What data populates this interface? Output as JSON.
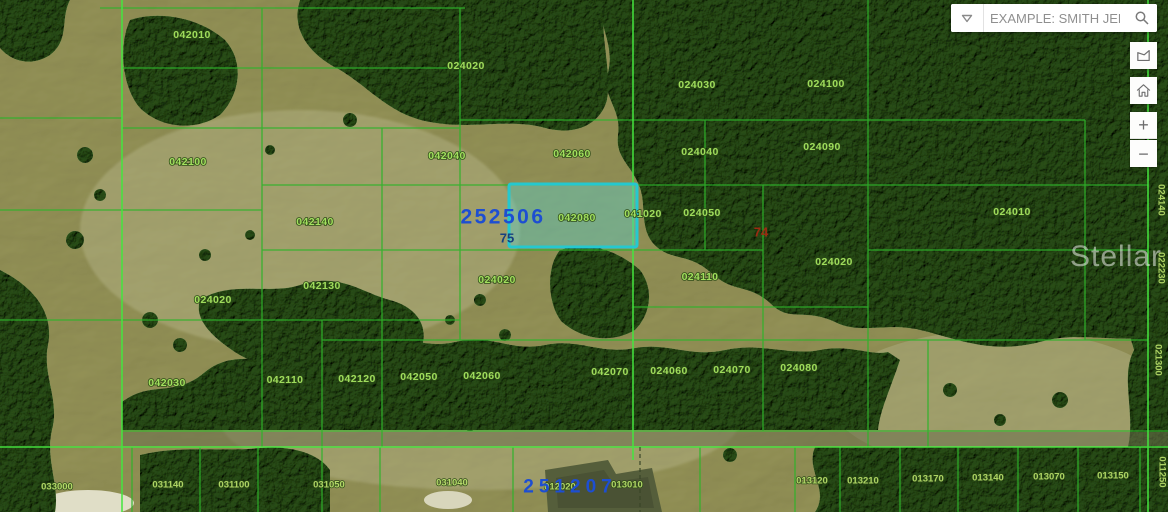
{
  "search": {
    "placeholder": "EXAMPLE: SMITH JER..."
  },
  "controls": {
    "zoom_in_label": "+",
    "zoom_out_label": "−"
  },
  "watermark": "Stellar MLS",
  "selected_parcel": {
    "section_label": "252506",
    "lot_label": "75",
    "parcel_id": "042080",
    "highlight_border_color": "#25c8cf",
    "highlight_fill_color": "rgba(90,210,205,0.42)"
  },
  "colors": {
    "parcel_line_green": "#2eb32a",
    "parcel_line_bright": "#45e53f",
    "parcel_label_green": "#a4e35f",
    "section_label_blue": "#1d4ed2",
    "note_red": "#9c2b12"
  },
  "map_labels": {
    "green_parcels": [
      {
        "t": "042010",
        "x": 192,
        "y": 35
      },
      {
        "t": "024020",
        "x": 466,
        "y": 66
      },
      {
        "t": "024030",
        "x": 697,
        "y": 85
      },
      {
        "t": "024100",
        "x": 826,
        "y": 84
      },
      {
        "t": "042100",
        "x": 188,
        "y": 162
      },
      {
        "t": "042040",
        "x": 447,
        "y": 156
      },
      {
        "t": "042060",
        "x": 572,
        "y": 154
      },
      {
        "t": "024040",
        "x": 700,
        "y": 152
      },
      {
        "t": "024090",
        "x": 822,
        "y": 147
      },
      {
        "t": "042080",
        "x": 577,
        "y": 218
      },
      {
        "t": "041020",
        "x": 643,
        "y": 214
      },
      {
        "t": "024050",
        "x": 702,
        "y": 213
      },
      {
        "t": "024010",
        "x": 1012,
        "y": 212
      },
      {
        "t": "042140",
        "x": 315,
        "y": 222
      },
      {
        "t": "024020",
        "x": 834,
        "y": 262
      },
      {
        "t": "042130",
        "x": 322,
        "y": 286
      },
      {
        "t": "024020",
        "x": 213,
        "y": 300
      },
      {
        "t": "024020",
        "x": 497,
        "y": 280
      },
      {
        "t": "024110",
        "x": 700,
        "y": 277
      },
      {
        "t": "042030",
        "x": 167,
        "y": 383
      },
      {
        "t": "042110",
        "x": 285,
        "y": 380
      },
      {
        "t": "042120",
        "x": 357,
        "y": 379
      },
      {
        "t": "042050",
        "x": 419,
        "y": 377
      },
      {
        "t": "042060",
        "x": 482,
        "y": 376
      },
      {
        "t": "042070",
        "x": 610,
        "y": 372
      },
      {
        "t": "024060",
        "x": 669,
        "y": 371
      },
      {
        "t": "024070",
        "x": 732,
        "y": 370
      },
      {
        "t": "024080",
        "x": 799,
        "y": 368
      },
      {
        "t": "033000",
        "x": 57,
        "y": 487,
        "sm": 1
      },
      {
        "t": "031140",
        "x": 168,
        "y": 485,
        "sm": 1
      },
      {
        "t": "031100",
        "x": 234,
        "y": 485,
        "sm": 1
      },
      {
        "t": "031050",
        "x": 329,
        "y": 485,
        "sm": 1
      },
      {
        "t": "031040",
        "x": 452,
        "y": 483,
        "sm": 1
      },
      {
        "t": "012020",
        "x": 560,
        "y": 487,
        "sm": 1
      },
      {
        "t": "013010",
        "x": 627,
        "y": 485,
        "sm": 1
      },
      {
        "t": "013120",
        "x": 812,
        "y": 481,
        "sm": 1
      },
      {
        "t": "013210",
        "x": 863,
        "y": 481,
        "sm": 1
      },
      {
        "t": "013170",
        "x": 928,
        "y": 479,
        "sm": 1
      },
      {
        "t": "013140",
        "x": 988,
        "y": 478,
        "sm": 1
      },
      {
        "t": "013070",
        "x": 1049,
        "y": 477,
        "sm": 1
      },
      {
        "t": "013150",
        "x": 1113,
        "y": 476,
        "sm": 1
      },
      {
        "t": "024140",
        "x": 1161,
        "y": 200,
        "rot": 90,
        "sm": 1
      },
      {
        "t": "022230",
        "x": 1161,
        "y": 268,
        "rot": 90,
        "sm": 1
      },
      {
        "t": "021300",
        "x": 1158,
        "y": 360,
        "rot": 90,
        "sm": 1
      },
      {
        "t": "011250",
        "x": 1162,
        "y": 472,
        "rot": 90,
        "sm": 1
      }
    ],
    "blue_sections": [
      {
        "t": "252506",
        "x": 503,
        "y": 217,
        "size": 21,
        "ls": 2.5
      },
      {
        "t": "251207",
        "x": 570,
        "y": 487,
        "size": 19,
        "ls": 5
      }
    ],
    "blue_small": [
      {
        "t": "75",
        "x": 507,
        "y": 238
      }
    ],
    "red_notes": [
      {
        "t": "74",
        "x": 761,
        "y": 232
      }
    ]
  }
}
